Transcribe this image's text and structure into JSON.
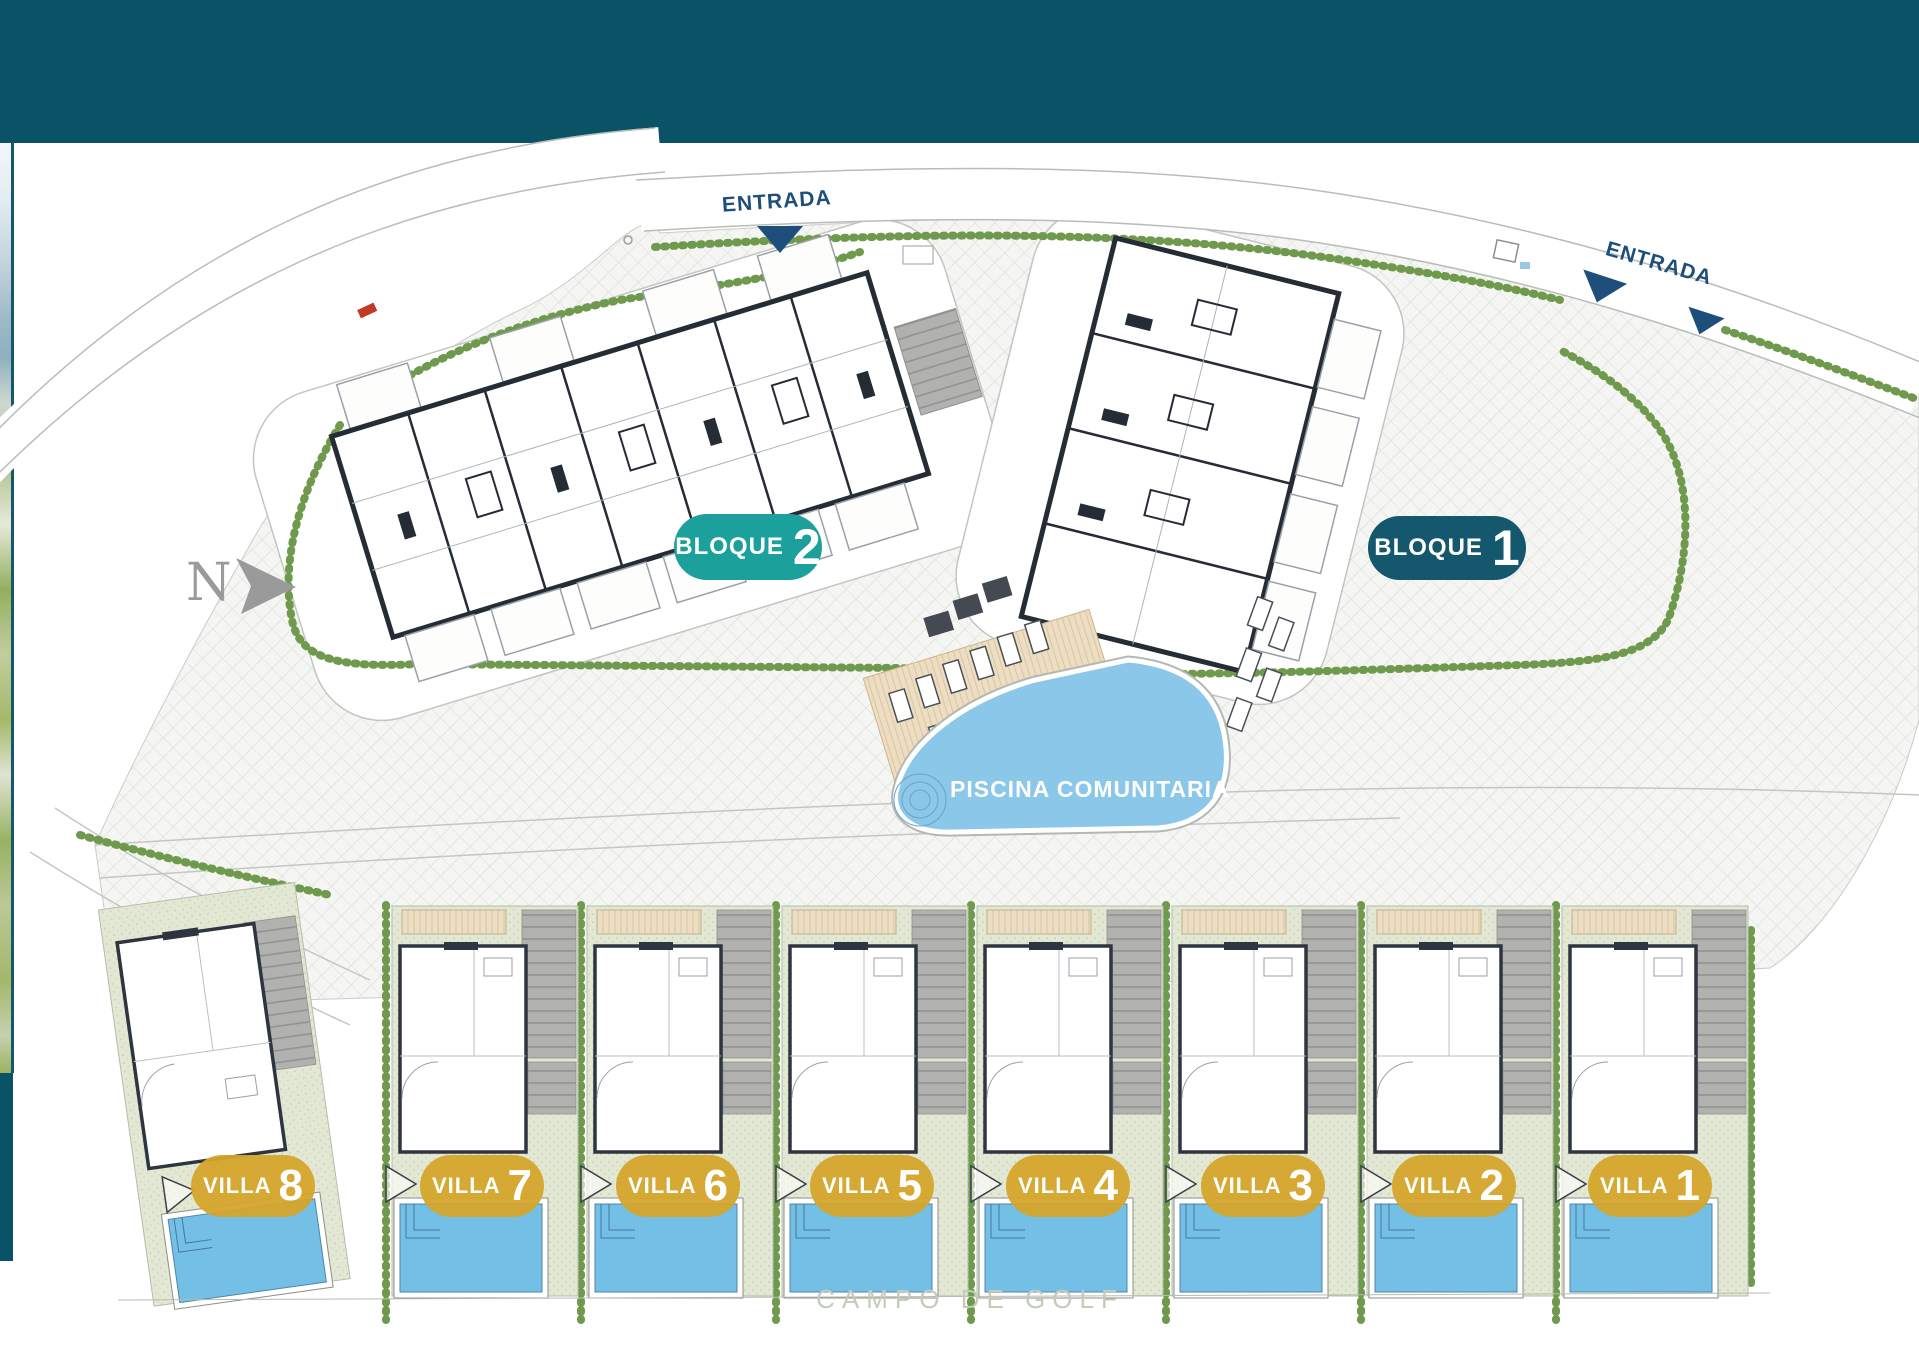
{
  "site_plan": {
    "entrances": [
      {
        "label": "ENTRADA"
      },
      {
        "label": "ENTRADA"
      }
    ],
    "blocks": {
      "bloque2": {
        "name": "BLOQUE",
        "number": "2"
      },
      "bloque1": {
        "name": "BLOQUE",
        "number": "1"
      }
    },
    "pool_label": "PISCINA COMUNITARIA",
    "golf_label": "CAMPO DE GOLF",
    "north_label": "N",
    "villas": [
      {
        "name": "VILLA",
        "number": "8"
      },
      {
        "name": "VILLA",
        "number": "7"
      },
      {
        "name": "VILLA",
        "number": "6"
      },
      {
        "name": "VILLA",
        "number": "5"
      },
      {
        "name": "VILLA",
        "number": "4"
      },
      {
        "name": "VILLA",
        "number": "3"
      },
      {
        "name": "VILLA",
        "number": "2"
      },
      {
        "name": "VILLA",
        "number": "1"
      }
    ]
  },
  "colors": {
    "header": "#0A5265",
    "bloque2_badge": "#1CA09B",
    "bloque1_badge": "#15586E",
    "villa_badge": "#D5A42B",
    "entrance_text": "#1E4E7C",
    "communal_pool": "#8AC7E9",
    "villa_pool": "#74BFE5",
    "hedge": "#6F9A4E",
    "golf_text": "#C3CBB9"
  }
}
